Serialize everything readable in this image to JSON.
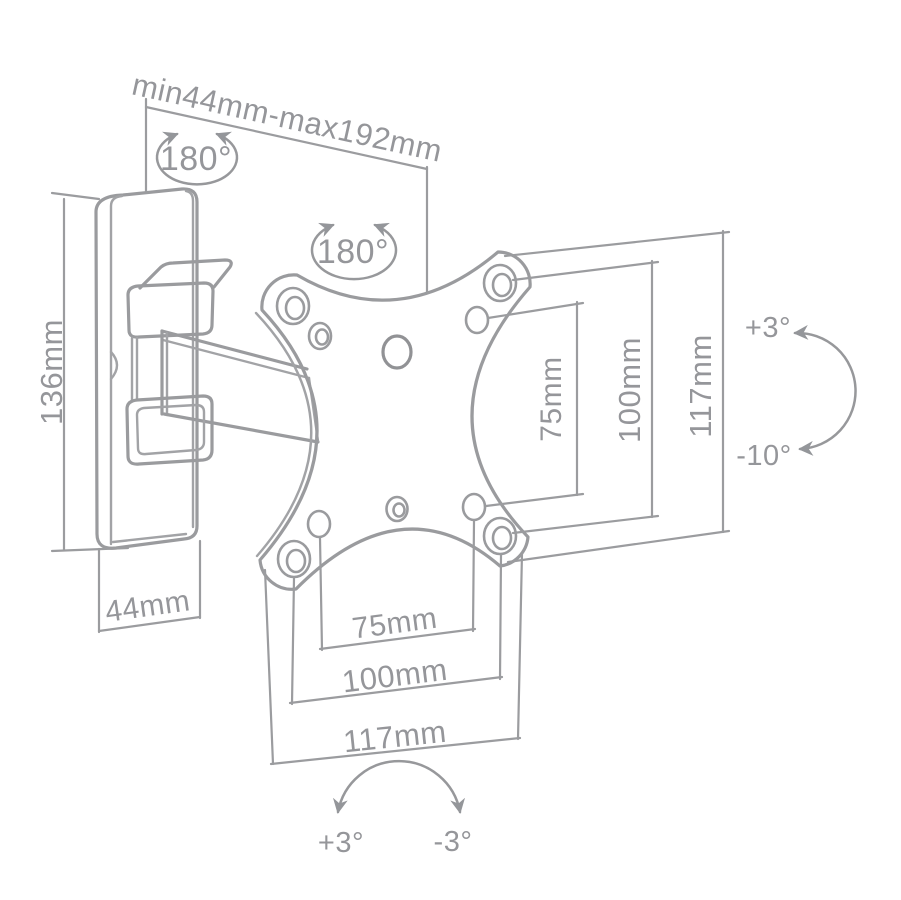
{
  "colors": {
    "background": "#ffffff",
    "line": "#9a9b9e",
    "text": "#95969a"
  },
  "dims": {
    "range": "min44mm-max192mm",
    "swivel_wall": "180°",
    "swivel_arm": "180°",
    "plate_height": "136mm",
    "plate_depth": "44mm",
    "vesa_v_inner": "75mm",
    "vesa_v_mid": "100mm",
    "vesa_v_outer": "117mm",
    "vesa_h_inner": "75mm",
    "vesa_h_mid": "100mm",
    "vesa_h_outer": "117mm",
    "tilt_up": "+3°",
    "tilt_down": "-10°",
    "level_left": "+3°",
    "level_right": "-3°"
  }
}
